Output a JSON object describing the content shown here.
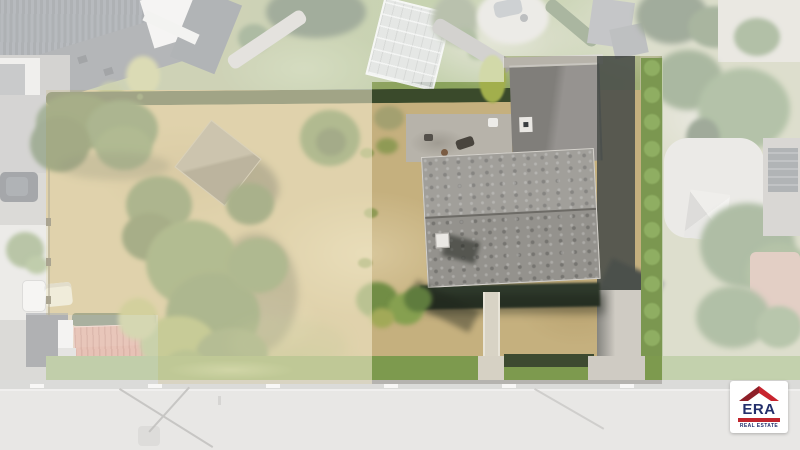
{
  "scene": {
    "description": "Aerial drone photo of a residential property; left building lot highlighted with a warm tint, surroundings faded white",
    "highlight_tint": "#f3e9c3",
    "surround_wash": "#ffffff"
  },
  "logo": {
    "brand": "ERA",
    "tagline": "REAL ESTATE",
    "navy": "#232f6b",
    "red": "#c0252d"
  }
}
